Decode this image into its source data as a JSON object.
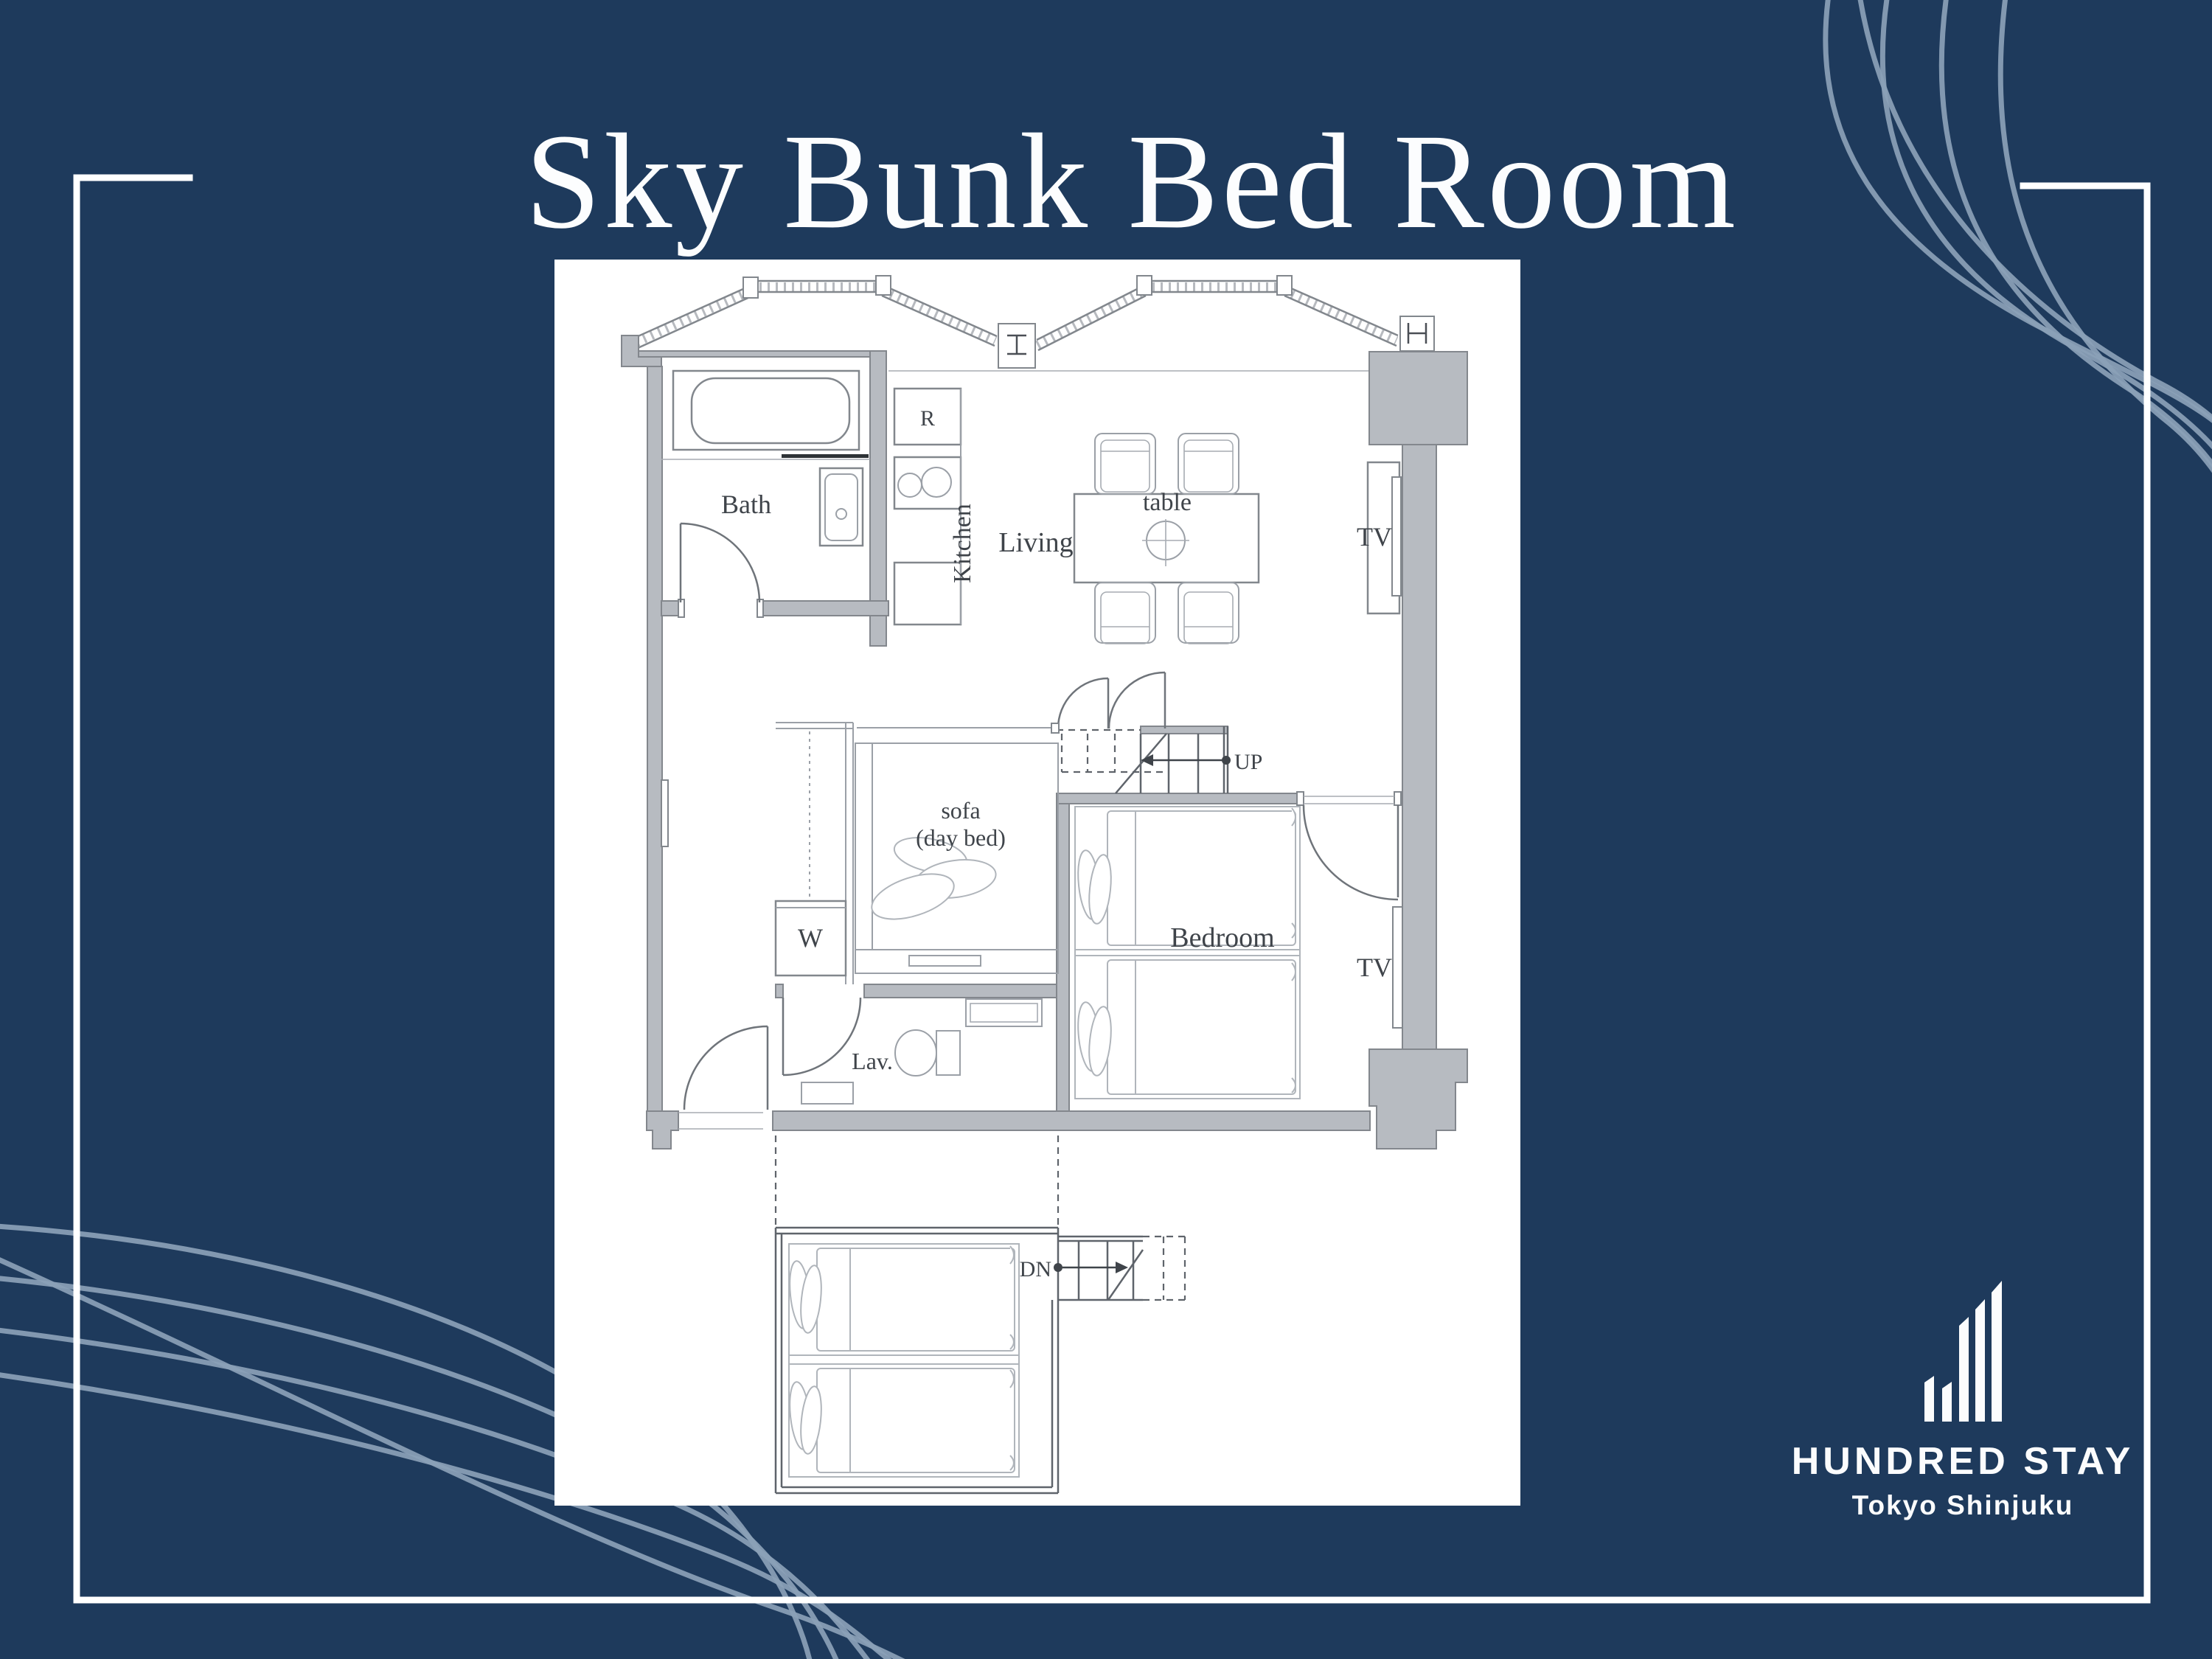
{
  "title": "Sky Bunk Bed Room",
  "plan": {
    "bath": "Bath",
    "refrigerator": "R",
    "kitchen": "Kitchen",
    "living": "Living",
    "table": "table",
    "tv_living": "TV",
    "sofa_line1": "sofa",
    "sofa_line2": "(day bed)",
    "washer": "W",
    "bedroom": "Bedroom",
    "tv_bedroom": "TV",
    "up": "UP",
    "dn": "DN",
    "lav": "Lav."
  },
  "logo": {
    "brand": "HUNDRED STAY",
    "subtitle": "Tokyo Shinjuku"
  },
  "colors": {
    "background": "#1e3a5c",
    "panel": "#ffffff",
    "wall_gray": "#b7bbc1",
    "wave_gray_blue": "#8ba1b7",
    "frame_white": "#ffffff",
    "plan_text": "#3f444a"
  }
}
